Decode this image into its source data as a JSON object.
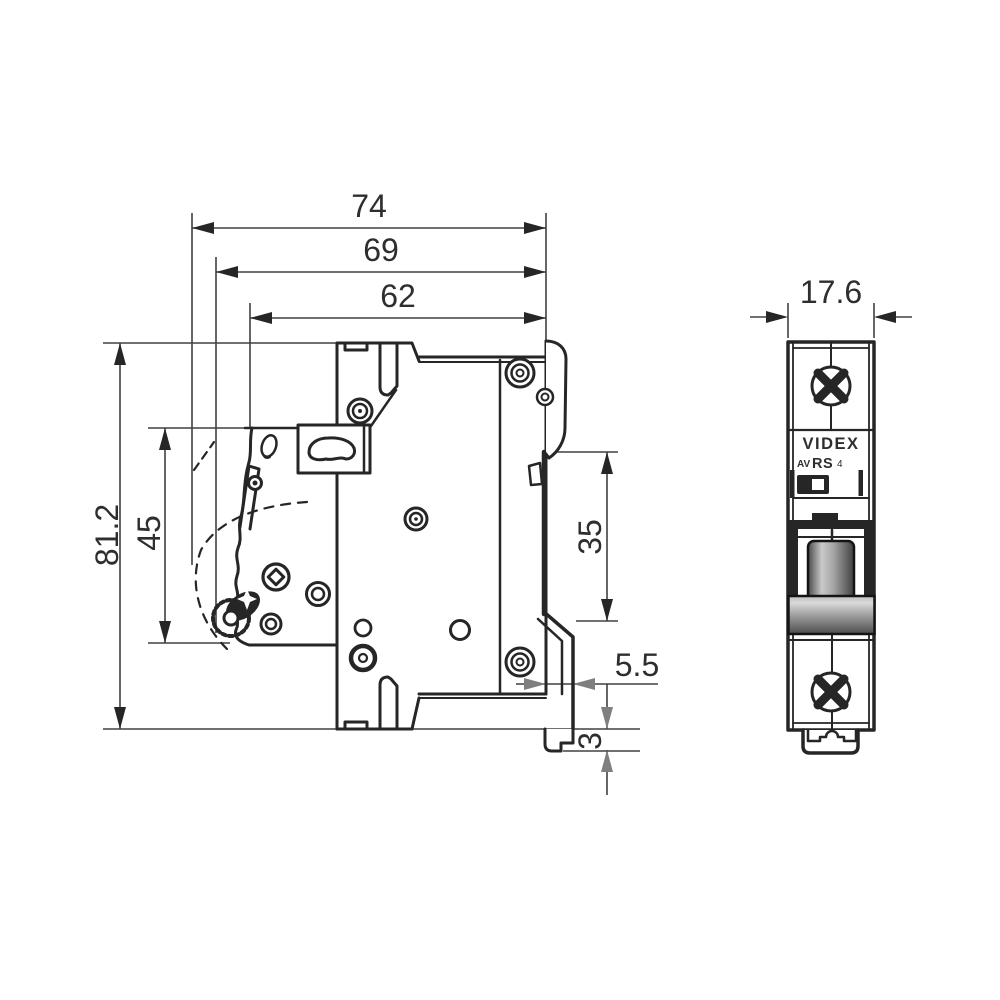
{
  "dimensions": {
    "total_depth": "74",
    "depth_without_toggle": "69",
    "body_depth": "62",
    "total_height": "81.2",
    "front_section_height": "45",
    "din_rail_height": "35",
    "rail_clip_offset": "5.5",
    "clip_foot_height": "3",
    "module_width": "17.6"
  },
  "front_label": {
    "brand": "VIDEX",
    "series_prefix": "AV",
    "series": "RS",
    "series_size": "4"
  },
  "colors": {
    "line": "#262626",
    "dim_line": "#404040",
    "gray_arrow": "#7f7f7f",
    "label_text": "#2e2e2e",
    "background": "#ffffff"
  }
}
